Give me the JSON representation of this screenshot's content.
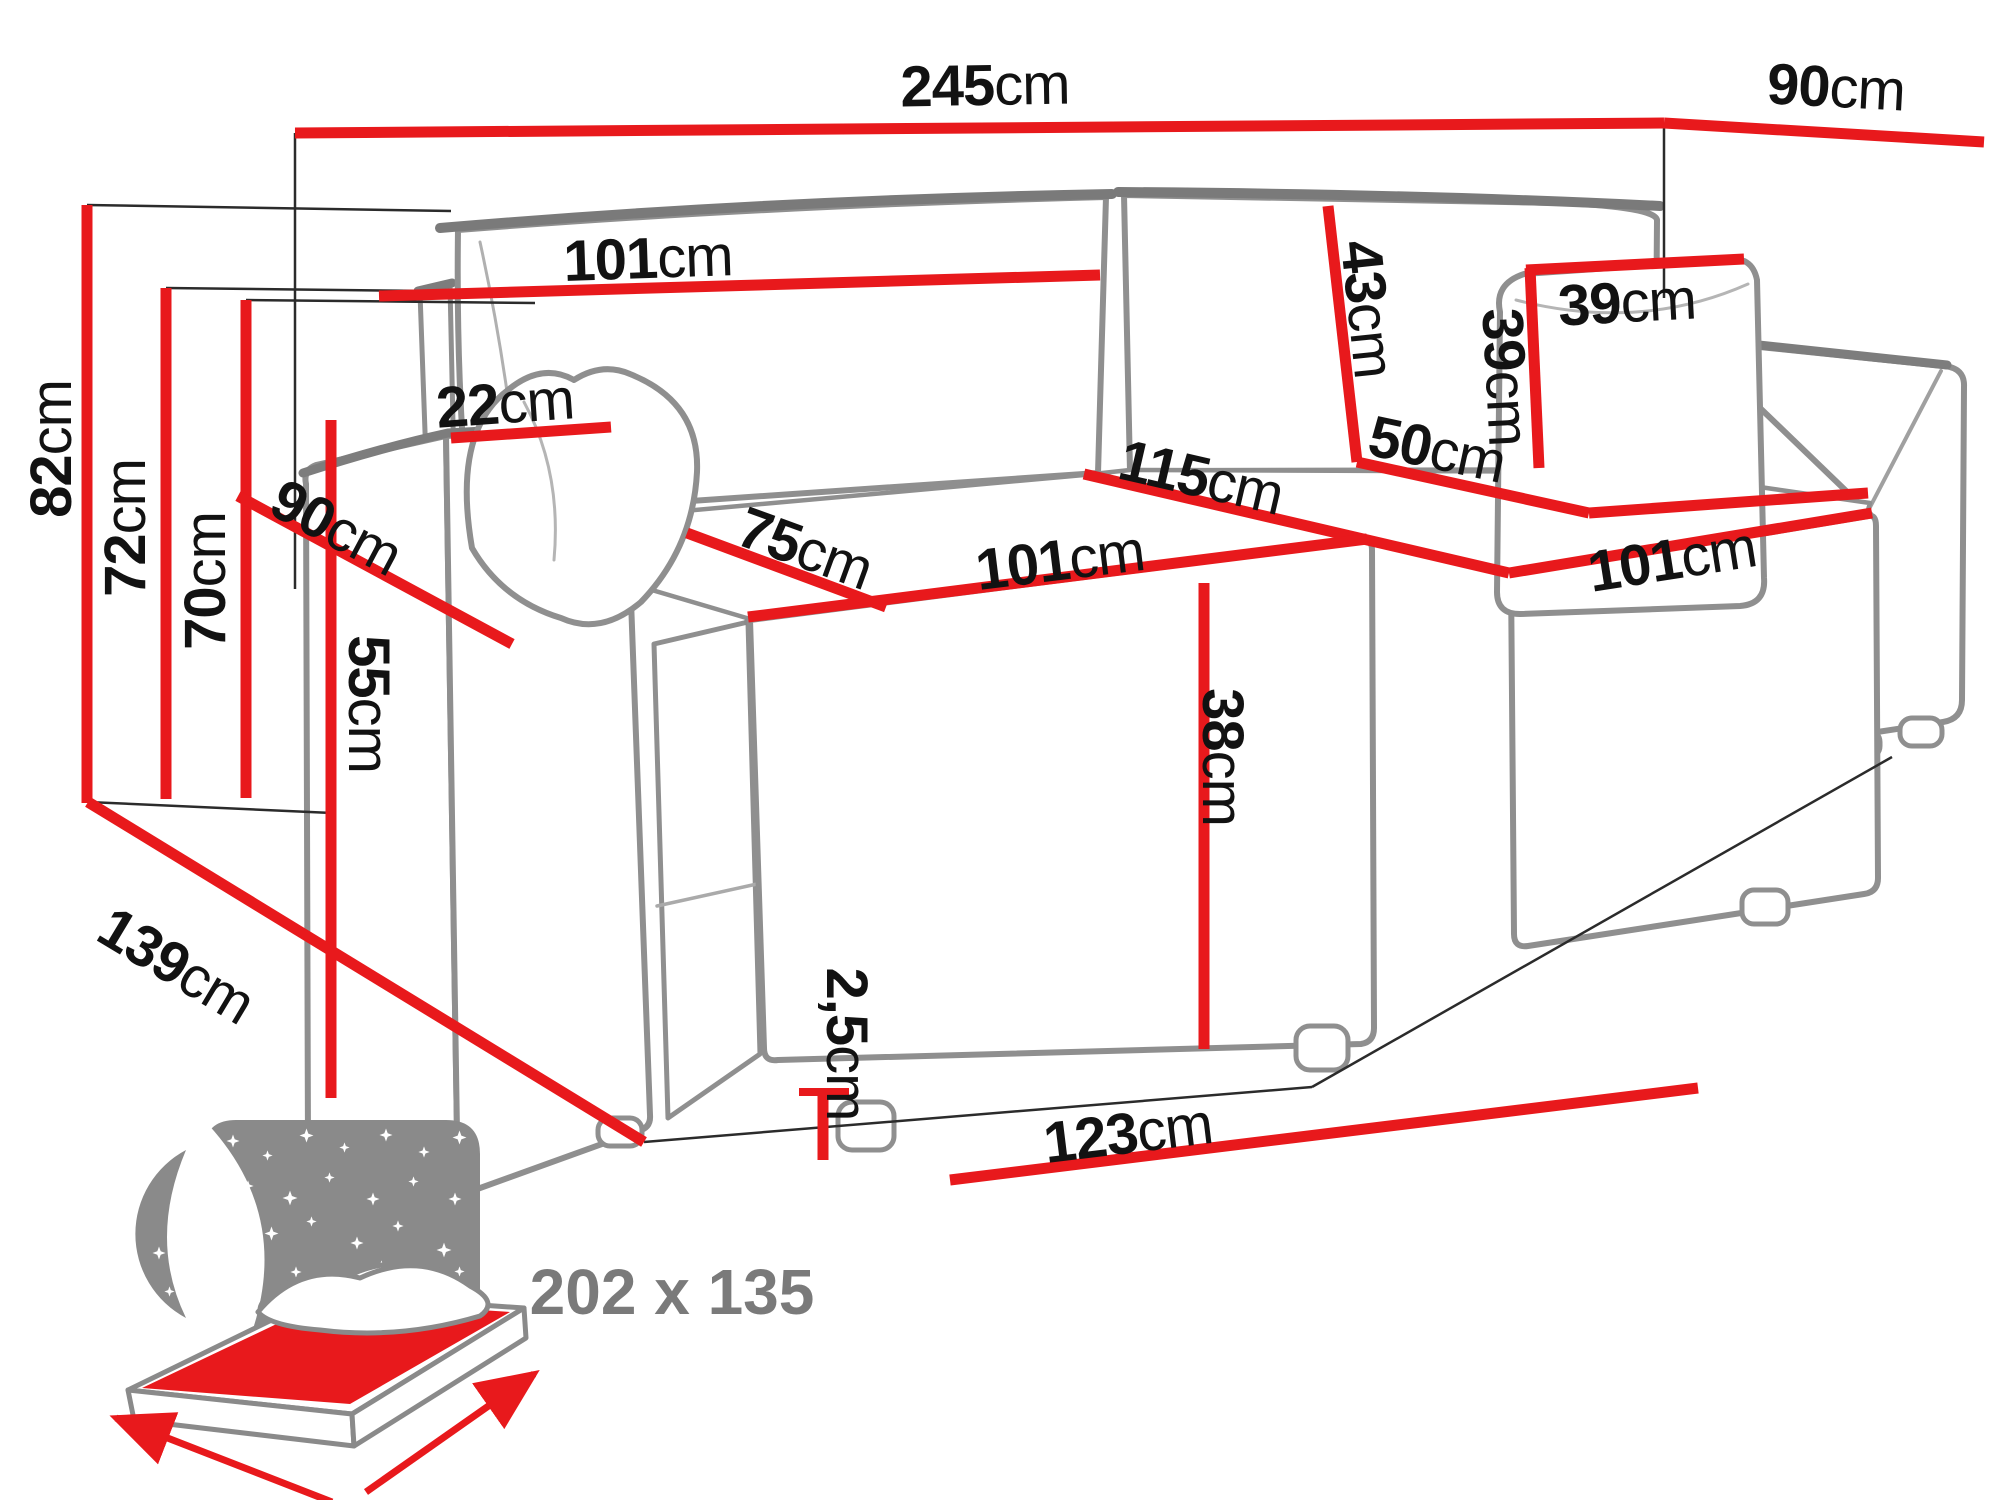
{
  "diagram": {
    "type": "corner-sofa-bed-dimension-diagram",
    "unit": "cm",
    "colors": {
      "dimension_line_red": "#e8191c",
      "sketch_gray": "#8f8f8f",
      "sleeping_size_text_gray": "#7a7a7a",
      "label_text": "#121212"
    },
    "dimensions": {
      "total_width": {
        "value": "245",
        "unit": "cm"
      },
      "total_depth": {
        "value": "90",
        "unit": "cm"
      },
      "total_height": {
        "value": "82",
        "unit": "cm"
      },
      "backrest_height": {
        "value": "72",
        "unit": "cm"
      },
      "backrest_height_2": {
        "value": "70",
        "unit": "cm"
      },
      "side_depth": {
        "value": "139",
        "unit": "cm"
      },
      "armrest_width": {
        "value": "22",
        "unit": "cm"
      },
      "armrest_depth": {
        "value": "90",
        "unit": "cm"
      },
      "armrest_height": {
        "value": "55",
        "unit": "cm"
      },
      "backrest_width": {
        "value": "101",
        "unit": "cm"
      },
      "back_cushion_height": {
        "value": "43",
        "unit": "cm"
      },
      "pillow_width": {
        "value": "39",
        "unit": "cm"
      },
      "pillow_height": {
        "value": "39",
        "unit": "cm"
      },
      "chaise_seat_back": {
        "value": "50",
        "unit": "cm"
      },
      "seat_diagonal": {
        "value": "115",
        "unit": "cm"
      },
      "seat_depth": {
        "value": "75",
        "unit": "cm"
      },
      "seat_width": {
        "value": "101",
        "unit": "cm"
      },
      "chaise_width": {
        "value": "101",
        "unit": "cm"
      },
      "seat_height": {
        "value": "38",
        "unit": "cm"
      },
      "leg_height": {
        "value": "2,5",
        "unit": "cm"
      },
      "bed_front_width": {
        "value": "123",
        "unit": "cm"
      }
    },
    "sleeping_area": {
      "label": "202 x 135"
    }
  }
}
